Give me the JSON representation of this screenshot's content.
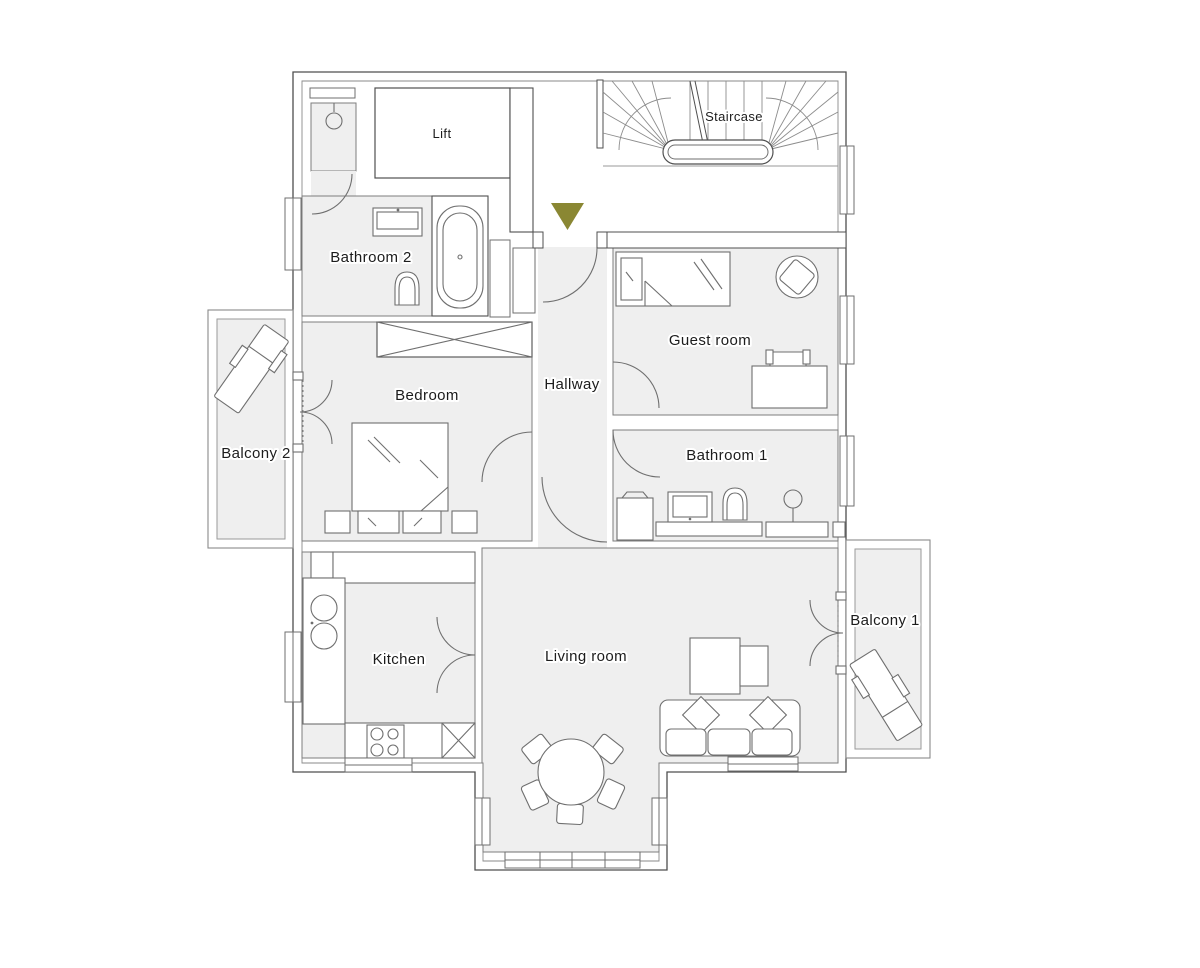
{
  "plan": {
    "type": "apartment-floor-plan",
    "rooms": {
      "lift": "Lift",
      "staircase": "Staircase",
      "bathroom2": "Bathroom 2",
      "guest_room": "Guest room",
      "hallway": "Hallway",
      "bedroom": "Bedroom",
      "balcony2": "Balcony 2",
      "bathroom1": "Bathroom 1",
      "kitchen": "Kitchen",
      "living_room": "Living room",
      "balcony1": "Balcony 1"
    },
    "icons": {
      "entrance_marker": "triangle-down-icon"
    },
    "colors": {
      "room_fill": "#efefef",
      "wall_line": "#4f4f4f",
      "furniture_line": "#6f6f6f",
      "light_line": "#9a9a9a",
      "entrance_marker": "#8a8733",
      "background": "#ffffff",
      "text": "#1c1c1c"
    }
  }
}
